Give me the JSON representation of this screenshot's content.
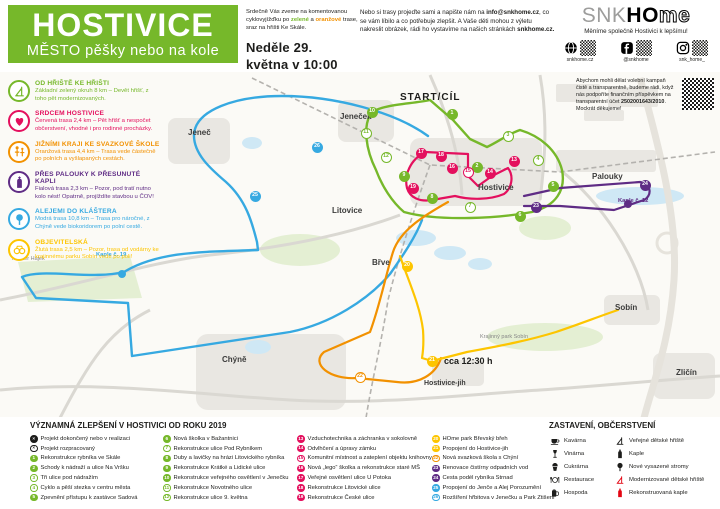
{
  "colors": {
    "green": "#76b82a",
    "red": "#e4105e",
    "orange": "#f29100",
    "purple": "#5f2c85",
    "blue": "#36a9e1",
    "yellow": "#fdc500",
    "black": "#1d1d1b",
    "icon_red": "#e30613"
  },
  "header": {
    "title": "HOSTIVICE",
    "subtitle": "MĚSTO pěšky nebo na kole",
    "invite": {
      "line1": "Srdečně Vás zveme na komentovanou cyklovyjížďku po ",
      "green_word": "zelené",
      "mid": " a ",
      "orange_word": "oranžové",
      "rest": " trase, sraz na hřišti Ke Skále.",
      "date": "Neděle 29. května v 10:00"
    },
    "feedback": {
      "part1": "Nebo si trasy projeďte sami a napište nám na ",
      "email": "info@snkhome.cz",
      "part2": ", co se vám líbilo a co potřebuje zlepšit. A Vaše děti mohou z výletu nakreslit obrázek, rádi ho vystavíme na našich stránkách ",
      "site": "snkhome.cz."
    },
    "brand": {
      "logo_snk": "SNK",
      "logo_ho": "HO",
      "logo_me": "me",
      "tagline": "Měníme společně Hostivici k lepšímu!",
      "socials": [
        {
          "icon": "web",
          "label": "snkhome.cz"
        },
        {
          "icon": "facebook",
          "label": "@snkhome"
        },
        {
          "icon": "instagram",
          "label": "snk_home_"
        }
      ]
    }
  },
  "routes_legend": [
    {
      "icon": "playground",
      "color": "#76b82a",
      "title": "OD HŘIŠTĚ KE HŘIŠTI",
      "body": "Základní zelený okruh 8 km – Devět hřišť, z toho pět modernizovaných."
    },
    {
      "icon": "heart",
      "color": "#e4105e",
      "title": "SRDCEM HOSTIVICE",
      "body": "Červená trasa 2,4 km – Pět hřišť a nespočet občerstvení, vhodné i pro rodinné procházky."
    },
    {
      "icon": "family",
      "color": "#f29100",
      "title": "JIŽNÍMI KRAJI KE SVAZKOVÉ ŠKOLE",
      "body": "Oranžová trasa 4,4 km – Trasa vede částečně po polních a vyšlapaných cestách."
    },
    {
      "icon": "chapel",
      "color": "#5f2c85",
      "title": "PŘES PALOUKY K PŘESUNUTÉ KAPLI",
      "body": "Fialová trasa 2,3 km – Pozor, pod tratí nutno kolo nést! Opatrně, projíždíte stavbou u ČOV!"
    },
    {
      "icon": "tree",
      "color": "#36a9e1",
      "title": "ALEJEMI DO KLÁŠTERA",
      "body": "Modrá trasa 10,8 km – Trasa pro náročné, z Chýně vede biokoridorem po polní cestě."
    },
    {
      "icon": "binoculars",
      "color": "#fdc500",
      "title": "OBJEVITELSKÁ",
      "body": "Žlutá trasa 2,5 km – Pozor, trasa od vodárny ke krajinnému parku Sobín vede po poli!"
    }
  ],
  "map": {
    "donate": {
      "part1": "Abychom mohli dělat volební kampaň čistě a transparentně, budeme rádi, když nás podpoříte finančním příspěvkem na transparentní účet ",
      "account": "2502001643/2010",
      "part2": ". Mockrát děkujeme!"
    },
    "labels": [
      {
        "text": "START/CÍL",
        "x": 400,
        "y": 92,
        "style": "start"
      },
      {
        "text": "Jeneček",
        "x": 340,
        "y": 112,
        "style": "town"
      },
      {
        "text": "Jeneč",
        "x": 188,
        "y": 128,
        "style": "town"
      },
      {
        "text": "Hostivice",
        "x": 478,
        "y": 183,
        "style": "town"
      },
      {
        "text": "Litovice",
        "x": 332,
        "y": 206,
        "style": "town"
      },
      {
        "text": "Břve",
        "x": 372,
        "y": 258,
        "style": "town"
      },
      {
        "text": "Chýně",
        "x": 222,
        "y": 355,
        "style": "town"
      },
      {
        "text": "Sobín",
        "x": 615,
        "y": 303,
        "style": "town"
      },
      {
        "text": "Zličín",
        "x": 676,
        "y": 368,
        "style": "town"
      },
      {
        "text": "Hostivice-jih",
        "x": 424,
        "y": 380,
        "style": "town-sm"
      },
      {
        "text": "Klášter Hájek",
        "x": 12,
        "y": 256,
        "style": "small"
      },
      {
        "text": "Kaple č. 19",
        "x": 96,
        "y": 252,
        "style": "blue"
      },
      {
        "text": "Palouky",
        "x": 592,
        "y": 172,
        "style": "town"
      },
      {
        "text": "Kaple č. 12",
        "x": 618,
        "y": 198,
        "style": "purple"
      },
      {
        "text": "cca 12:30 h",
        "x": 444,
        "y": 356,
        "style": "time"
      },
      {
        "text": "Krajinný park Sobín",
        "x": 480,
        "y": 334,
        "style": "small"
      }
    ],
    "markers": [
      {
        "n": "1",
        "color": "green",
        "filled": true,
        "x": 452,
        "y": 114
      },
      {
        "n": "2",
        "color": "green",
        "filled": true,
        "x": 477,
        "y": 167
      },
      {
        "n": "3",
        "color": "green",
        "filled": false,
        "x": 508,
        "y": 136
      },
      {
        "n": "4",
        "color": "green",
        "filled": false,
        "x": 538,
        "y": 160
      },
      {
        "n": "5",
        "color": "green",
        "filled": true,
        "x": 553,
        "y": 186
      },
      {
        "n": "6",
        "color": "green",
        "filled": true,
        "x": 520,
        "y": 216
      },
      {
        "n": "7",
        "color": "green",
        "filled": false,
        "x": 470,
        "y": 207
      },
      {
        "n": "8",
        "color": "green",
        "filled": true,
        "x": 432,
        "y": 198
      },
      {
        "n": "9",
        "color": "green",
        "filled": true,
        "x": 404,
        "y": 176
      },
      {
        "n": "10",
        "color": "green",
        "filled": true,
        "x": 372,
        "y": 112
      },
      {
        "n": "11",
        "color": "green",
        "filled": false,
        "x": 366,
        "y": 133
      },
      {
        "n": "12",
        "color": "green",
        "filled": false,
        "x": 386,
        "y": 157
      },
      {
        "n": "13",
        "color": "red",
        "filled": true,
        "x": 514,
        "y": 161
      },
      {
        "n": "14",
        "color": "red",
        "filled": true,
        "x": 490,
        "y": 173
      },
      {
        "n": "15",
        "color": "red",
        "filled": false,
        "x": 468,
        "y": 172
      },
      {
        "n": "16",
        "color": "red",
        "filled": true,
        "x": 452,
        "y": 168
      },
      {
        "n": "17",
        "color": "red",
        "filled": true,
        "x": 421,
        "y": 153
      },
      {
        "n": "18",
        "color": "red",
        "filled": true,
        "x": 441,
        "y": 156
      },
      {
        "n": "19",
        "color": "red",
        "filled": true,
        "x": 413,
        "y": 188
      },
      {
        "n": "20",
        "color": "yellow",
        "filled": true,
        "x": 407,
        "y": 266
      },
      {
        "n": "21",
        "color": "yellow",
        "filled": true,
        "x": 432,
        "y": 361
      },
      {
        "n": "22",
        "color": "orange",
        "filled": false,
        "x": 360,
        "y": 377
      },
      {
        "n": "23",
        "color": "purple",
        "filled": true,
        "x": 536,
        "y": 207
      },
      {
        "n": "24",
        "color": "purple",
        "filled": true,
        "x": 645,
        "y": 185
      },
      {
        "n": "25",
        "color": "blue",
        "filled": true,
        "x": 255,
        "y": 196
      },
      {
        "n": "26",
        "color": "blue",
        "filled": true,
        "x": 317,
        "y": 147
      }
    ]
  },
  "improvements": {
    "heading": "VÝZNAMNÁ ZLEPŠENÍ V HOSTIVICI OD ROKU 2019",
    "legend": [
      {
        "marker": "x-filled",
        "label": "Projekt dokončený nebo v realizaci"
      },
      {
        "marker": "x-outline",
        "label": "Projekt rozpracovaný"
      }
    ],
    "items": [
      {
        "n": "1",
        "color": "green",
        "filled": true,
        "label": "Rekonstrukce rybníka ve Skále"
      },
      {
        "n": "2",
        "color": "green",
        "filled": true,
        "label": "Schody k nádraží a ulice Na Vršku"
      },
      {
        "n": "3",
        "color": "green",
        "filled": false,
        "label": "Tři ulice pod nádražím"
      },
      {
        "n": "4",
        "color": "green",
        "filled": false,
        "label": "Cyklo a pěší stezka v centru města"
      },
      {
        "n": "5",
        "color": "green",
        "filled": true,
        "label": "Zpevnění přístupu k zastávce Sadová"
      },
      {
        "n": "6",
        "color": "green",
        "filled": true,
        "label": "Nová školka v Bažantnici"
      },
      {
        "n": "7",
        "color": "green",
        "filled": false,
        "label": "Rekonstrukce ulice Pod Rybníkem"
      },
      {
        "n": "8",
        "color": "green",
        "filled": true,
        "label": "Duby a lavičky na hrázi Litovického rybníka"
      },
      {
        "n": "9",
        "color": "green",
        "filled": true,
        "label": "Rekonstrukce Krátké a Lidické ulice"
      },
      {
        "n": "10",
        "color": "green",
        "filled": true,
        "label": "Rekonstrukce veřejného osvětlení v Jenečku"
      },
      {
        "n": "11",
        "color": "green",
        "filled": false,
        "label": "Rekonstrukce Novotného ulice"
      },
      {
        "n": "12",
        "color": "green",
        "filled": false,
        "label": "Rekonstrukce ulice 9. května"
      },
      {
        "n": "13",
        "color": "red",
        "filled": true,
        "label": "Vzduchotechnika a záchranka v sokolovně"
      },
      {
        "n": "14",
        "color": "red",
        "filled": true,
        "label": "Odvlhčení a úpravy zámku"
      },
      {
        "n": "15",
        "color": "red",
        "filled": false,
        "label": "Komunitní místnost a zateplení objektu knihovny"
      },
      {
        "n": "16",
        "color": "red",
        "filled": true,
        "label": "Nová „lego“ školka a rekonstrukce staré MŠ"
      },
      {
        "n": "17",
        "color": "red",
        "filled": true,
        "label": "Veřejné osvětlení ulice U Potoka"
      },
      {
        "n": "18",
        "color": "red",
        "filled": true,
        "label": "Rekonstrukce Litovické ulice"
      },
      {
        "n": "19",
        "color": "red",
        "filled": true,
        "label": "Rekonstrukce České ulice"
      },
      {
        "n": "20",
        "color": "yellow",
        "filled": true,
        "label": "HOme park Břevský břeh"
      },
      {
        "n": "21",
        "color": "yellow",
        "filled": true,
        "label": "Propojení do Hostivice-jih"
      },
      {
        "n": "22",
        "color": "orange",
        "filled": false,
        "label": "Nová svazková škola s Chýní"
      },
      {
        "n": "23",
        "color": "purple",
        "filled": true,
        "label": "Renovace čistírny odpadních vod"
      },
      {
        "n": "24",
        "color": "purple",
        "filled": true,
        "label": "Cesta podél rybníka Strnad"
      },
      {
        "n": "25",
        "color": "blue",
        "filled": true,
        "label": "Propojení do Jenče a Alej Porozumění"
      },
      {
        "n": "26",
        "color": "blue",
        "filled": false,
        "label": "Rozšíření hřbitova v Jenečku a Park Ztišení"
      }
    ]
  },
  "stops": {
    "heading": "ZASTAVENÍ, OBČERSTVENÍ",
    "column_a": [
      {
        "icon": "coffee",
        "color": "black",
        "label": "Kavárna"
      },
      {
        "icon": "wine",
        "color": "black",
        "label": "Vinárna"
      },
      {
        "icon": "cake",
        "color": "black",
        "label": "Cukrárna"
      },
      {
        "icon": "restaurant",
        "color": "black",
        "label": "Restaurace"
      },
      {
        "icon": "beer",
        "color": "black",
        "label": "Hospoda"
      }
    ],
    "column_b": [
      {
        "icon": "playground",
        "color": "black",
        "label": "Veřejné dětské hřiště"
      },
      {
        "icon": "chapel",
        "color": "black",
        "label": "Kaple"
      },
      {
        "icon": "tree",
        "color": "black",
        "label": "Nové vysazené stromy"
      },
      {
        "icon": "playground",
        "color": "red",
        "label": "Modernizované dětské hřiště"
      },
      {
        "icon": "chapel",
        "color": "red",
        "label": "Rekonstruovaná kaple"
      }
    ]
  }
}
